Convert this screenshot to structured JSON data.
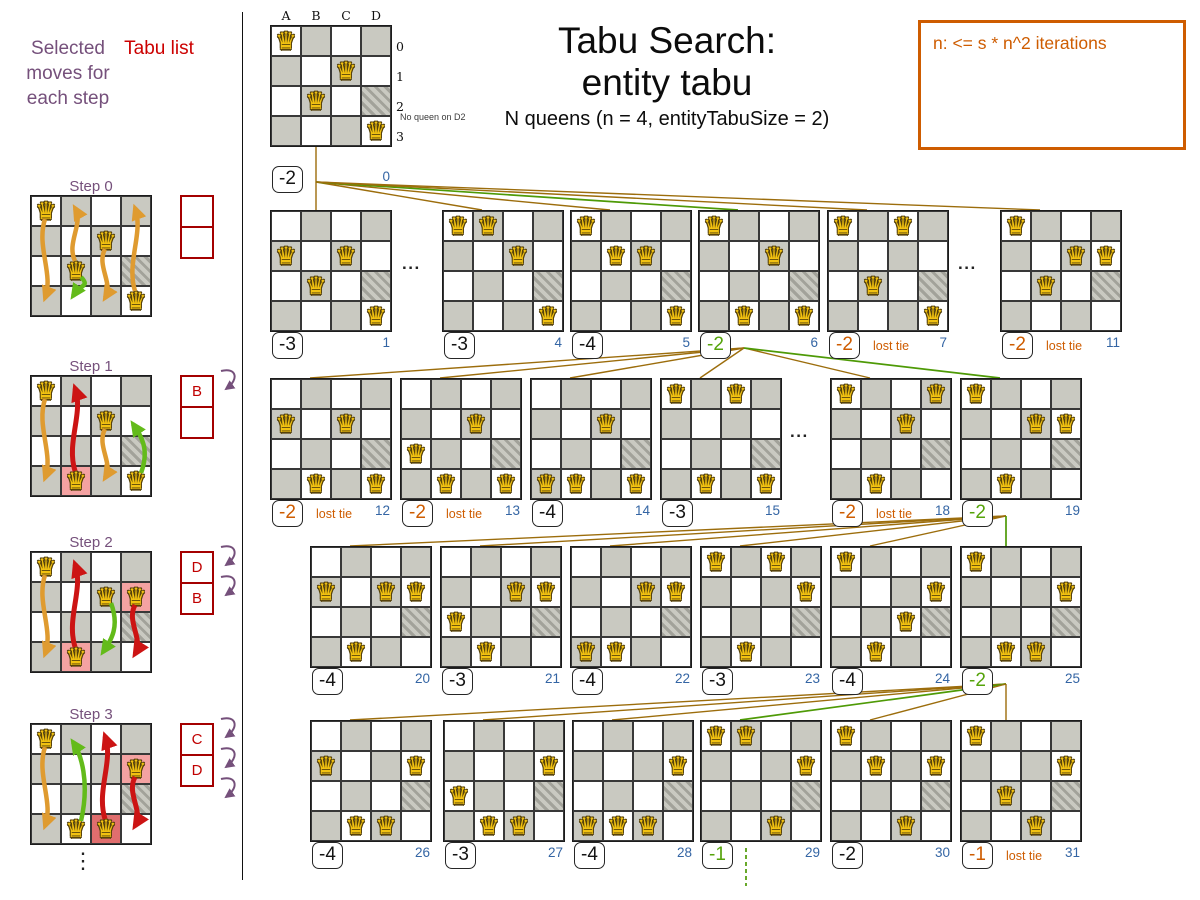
{
  "left_panel": {
    "selected_moves_label": "Selected moves for each step",
    "tabu_list_label": "Tabu list",
    "ellipsis": "⋮",
    "steps": [
      {
        "label": "Step 0",
        "queens": [
          "A0",
          "C1",
          "B2",
          "D3"
        ],
        "pink": [],
        "dark_pink": [],
        "candidates": [
          "A",
          "B",
          "C",
          "D"
        ],
        "tabu_moves": [],
        "selected_move": {
          "col": "B",
          "from": 2,
          "to": 3
        },
        "tabu_list": [
          "",
          ""
        ],
        "insert_arrows": 0
      },
      {
        "label": "Step 1",
        "queens": [
          "A0",
          "C1",
          "B3",
          "D3"
        ],
        "pink": [
          "B3"
        ],
        "dark_pink": [],
        "candidates": [
          "A",
          "C"
        ],
        "tabu_moves": [
          {
            "col": "B",
            "at": 3
          }
        ],
        "selected_move": {
          "col": "D",
          "from": 3,
          "to": 1
        },
        "tabu_list": [
          "B",
          ""
        ],
        "insert_arrows": 1
      },
      {
        "label": "Step 2",
        "queens": [
          "A0",
          "C1",
          "D1",
          "B3"
        ],
        "pink": [
          "D1",
          "B3"
        ],
        "dark_pink": [],
        "candidates": [
          "A"
        ],
        "tabu_moves": [
          {
            "col": "B",
            "at": 3
          },
          {
            "col": "D",
            "at": 1
          }
        ],
        "selected_move": {
          "col": "C",
          "from": 1,
          "to": 3
        },
        "tabu_list": [
          "D",
          "B"
        ],
        "insert_arrows": 2
      },
      {
        "label": "Step 3",
        "queens": [
          "A0",
          "D1",
          "B3",
          "C3"
        ],
        "pink": [
          "D1"
        ],
        "dark_pink": [
          "C3"
        ],
        "candidates": [
          "A"
        ],
        "tabu_moves": [
          {
            "col": "C",
            "at": 3
          },
          {
            "col": "D",
            "at": 1
          }
        ],
        "selected_move": {
          "col": "B",
          "from": 3,
          "to": 0
        },
        "tabu_list": [
          "C",
          "D"
        ],
        "insert_arrows": 3
      }
    ]
  },
  "header": {
    "title_line1": "Tabu Search:",
    "title_line2": "entity tabu",
    "subtitle": "N queens (n = 4, entityTabuSize = 2)"
  },
  "note_box": {
    "text": "n: <= s * n^2 iterations"
  },
  "root": {
    "col_labels": [
      "A",
      "B",
      "C",
      "D"
    ],
    "row_labels": [
      "0",
      "1",
      "2",
      "3"
    ],
    "annotation": "No queen on D2"
  },
  "glyphs": {
    "queen": "♛",
    "dots": "...",
    "v_dots": "⋮"
  },
  "colors": {
    "purple": "#75507b",
    "tabu_red": "#a40000",
    "tabu_text": "#c00000",
    "orange": "#ce5c00",
    "green": "#4e9a06",
    "green_arrow": "#63bb1a",
    "red_arrow": "#cc1414",
    "orange_arrow": "#df9b30",
    "blue": "#3465a4",
    "brown": "#9c6d0c",
    "board_gray": "#c9c9c1"
  },
  "tree": {
    "lost_tie_label": "lost tie",
    "boards": [
      {
        "id": 0,
        "x": 270,
        "y": 25,
        "queens": [
          "A0",
          "C1",
          "B2",
          "D3"
        ],
        "score": "-2",
        "status": "normal",
        "index": "0",
        "root": true
      },
      {
        "id": 1,
        "x": 270,
        "y": 210,
        "queens": [
          "A1",
          "C1",
          "B2",
          "D3"
        ],
        "score": "-3",
        "status": "normal",
        "index": "1"
      },
      {
        "id": 4,
        "x": 442,
        "y": 210,
        "queens": [
          "A0",
          "B0",
          "C1",
          "D3"
        ],
        "score": "-3",
        "status": "normal",
        "index": "4"
      },
      {
        "id": 5,
        "x": 570,
        "y": 210,
        "queens": [
          "A0",
          "B1",
          "C1",
          "D3"
        ],
        "score": "-4",
        "status": "normal",
        "index": "5"
      },
      {
        "id": 6,
        "x": 698,
        "y": 210,
        "queens": [
          "A0",
          "C1",
          "B3",
          "D3"
        ],
        "score": "-2",
        "status": "selected",
        "index": "6"
      },
      {
        "id": 7,
        "x": 827,
        "y": 210,
        "queens": [
          "A0",
          "C0",
          "B2",
          "D3"
        ],
        "score": "-2",
        "status": "lost_tie",
        "index": "7"
      },
      {
        "id": 11,
        "x": 1000,
        "y": 210,
        "queens": [
          "A0",
          "C1",
          "D1",
          "B2"
        ],
        "score": "-2",
        "status": "lost_tie",
        "index": "11"
      },
      {
        "id": 12,
        "x": 270,
        "y": 378,
        "queens": [
          "A1",
          "C1",
          "B3",
          "D3"
        ],
        "score": "-2",
        "status": "lost_tie",
        "index": "12"
      },
      {
        "id": 13,
        "x": 400,
        "y": 378,
        "queens": [
          "A2",
          "C1",
          "B3",
          "D3"
        ],
        "score": "-2",
        "status": "lost_tie",
        "index": "13"
      },
      {
        "id": 14,
        "x": 530,
        "y": 378,
        "queens": [
          "A3",
          "C1",
          "B3",
          "D3"
        ],
        "score": "-4",
        "status": "normal",
        "index": "14"
      },
      {
        "id": 15,
        "x": 660,
        "y": 378,
        "queens": [
          "A0",
          "C0",
          "B3",
          "D3"
        ],
        "score": "-3",
        "status": "normal",
        "index": "15"
      },
      {
        "id": 18,
        "x": 830,
        "y": 378,
        "queens": [
          "A0",
          "D0",
          "C1",
          "B3"
        ],
        "score": "-2",
        "status": "lost_tie",
        "index": "18"
      },
      {
        "id": 19,
        "x": 960,
        "y": 378,
        "queens": [
          "A0",
          "C1",
          "D1",
          "B3"
        ],
        "score": "-2",
        "status": "selected",
        "index": "19"
      },
      {
        "id": 20,
        "x": 310,
        "y": 546,
        "queens": [
          "A1",
          "C1",
          "D1",
          "B3"
        ],
        "score": "-4",
        "status": "normal",
        "index": "20"
      },
      {
        "id": 21,
        "x": 440,
        "y": 546,
        "queens": [
          "A2",
          "C1",
          "D1",
          "B3"
        ],
        "score": "-3",
        "status": "normal",
        "index": "21"
      },
      {
        "id": 22,
        "x": 570,
        "y": 546,
        "queens": [
          "A3",
          "C1",
          "D1",
          "B3"
        ],
        "score": "-4",
        "status": "normal",
        "index": "22"
      },
      {
        "id": 23,
        "x": 700,
        "y": 546,
        "queens": [
          "A0",
          "C0",
          "D1",
          "B3"
        ],
        "score": "-3",
        "status": "normal",
        "index": "23"
      },
      {
        "id": 24,
        "x": 830,
        "y": 546,
        "queens": [
          "A0",
          "C2",
          "D1",
          "B3"
        ],
        "score": "-4",
        "status": "normal",
        "index": "24"
      },
      {
        "id": 25,
        "x": 960,
        "y": 546,
        "queens": [
          "A0",
          "C3",
          "D1",
          "B3"
        ],
        "score": "-2",
        "status": "selected",
        "index": "25"
      },
      {
        "id": 26,
        "x": 310,
        "y": 720,
        "queens": [
          "A1",
          "B3",
          "C3",
          "D1"
        ],
        "score": "-4",
        "status": "normal",
        "index": "26"
      },
      {
        "id": 27,
        "x": 443,
        "y": 720,
        "queens": [
          "A2",
          "B3",
          "C3",
          "D1"
        ],
        "score": "-3",
        "status": "normal",
        "index": "27"
      },
      {
        "id": 28,
        "x": 572,
        "y": 720,
        "queens": [
          "A3",
          "B3",
          "C3",
          "D1"
        ],
        "score": "-4",
        "status": "normal",
        "index": "28"
      },
      {
        "id": 29,
        "x": 700,
        "y": 720,
        "queens": [
          "A0",
          "B0",
          "C3",
          "D1"
        ],
        "score": "-1",
        "status": "selected",
        "index": "29"
      },
      {
        "id": 30,
        "x": 830,
        "y": 720,
        "queens": [
          "A0",
          "B1",
          "C3",
          "D1"
        ],
        "score": "-2",
        "status": "normal",
        "index": "30"
      },
      {
        "id": 31,
        "x": 960,
        "y": 720,
        "queens": [
          "A0",
          "B2",
          "C3",
          "D1"
        ],
        "score": "-1",
        "status": "lost_tie",
        "index": "31"
      }
    ],
    "edges": [
      {
        "from": 0,
        "to": 1,
        "selected": false
      },
      {
        "from": 0,
        "to": 4,
        "selected": false
      },
      {
        "from": 0,
        "to": 5,
        "selected": false
      },
      {
        "from": 0,
        "to": 6,
        "selected": true
      },
      {
        "from": 0,
        "to": 7,
        "selected": false
      },
      {
        "from": 0,
        "to": 11,
        "selected": false
      },
      {
        "from": 6,
        "to": 12,
        "selected": false
      },
      {
        "from": 6,
        "to": 13,
        "selected": false
      },
      {
        "from": 6,
        "to": 14,
        "selected": false
      },
      {
        "from": 6,
        "to": 15,
        "selected": false
      },
      {
        "from": 6,
        "to": 18,
        "selected": false
      },
      {
        "from": 6,
        "to": 19,
        "selected": true
      },
      {
        "from": 19,
        "to": 20,
        "selected": false
      },
      {
        "from": 19,
        "to": 21,
        "selected": false
      },
      {
        "from": 19,
        "to": 22,
        "selected": false
      },
      {
        "from": 19,
        "to": 23,
        "selected": false
      },
      {
        "from": 19,
        "to": 24,
        "selected": false
      },
      {
        "from": 19,
        "to": 25,
        "selected": true
      },
      {
        "from": 25,
        "to": 26,
        "selected": false
      },
      {
        "from": 25,
        "to": 27,
        "selected": false
      },
      {
        "from": 25,
        "to": 28,
        "selected": false
      },
      {
        "from": 25,
        "to": 29,
        "selected": true
      },
      {
        "from": 25,
        "to": 30,
        "selected": false
      },
      {
        "from": 25,
        "to": 31,
        "selected": false
      }
    ],
    "gap_dots": [
      {
        "x": 402,
        "y": 254
      },
      {
        "x": 958,
        "y": 254
      },
      {
        "x": 790,
        "y": 422
      }
    ]
  }
}
